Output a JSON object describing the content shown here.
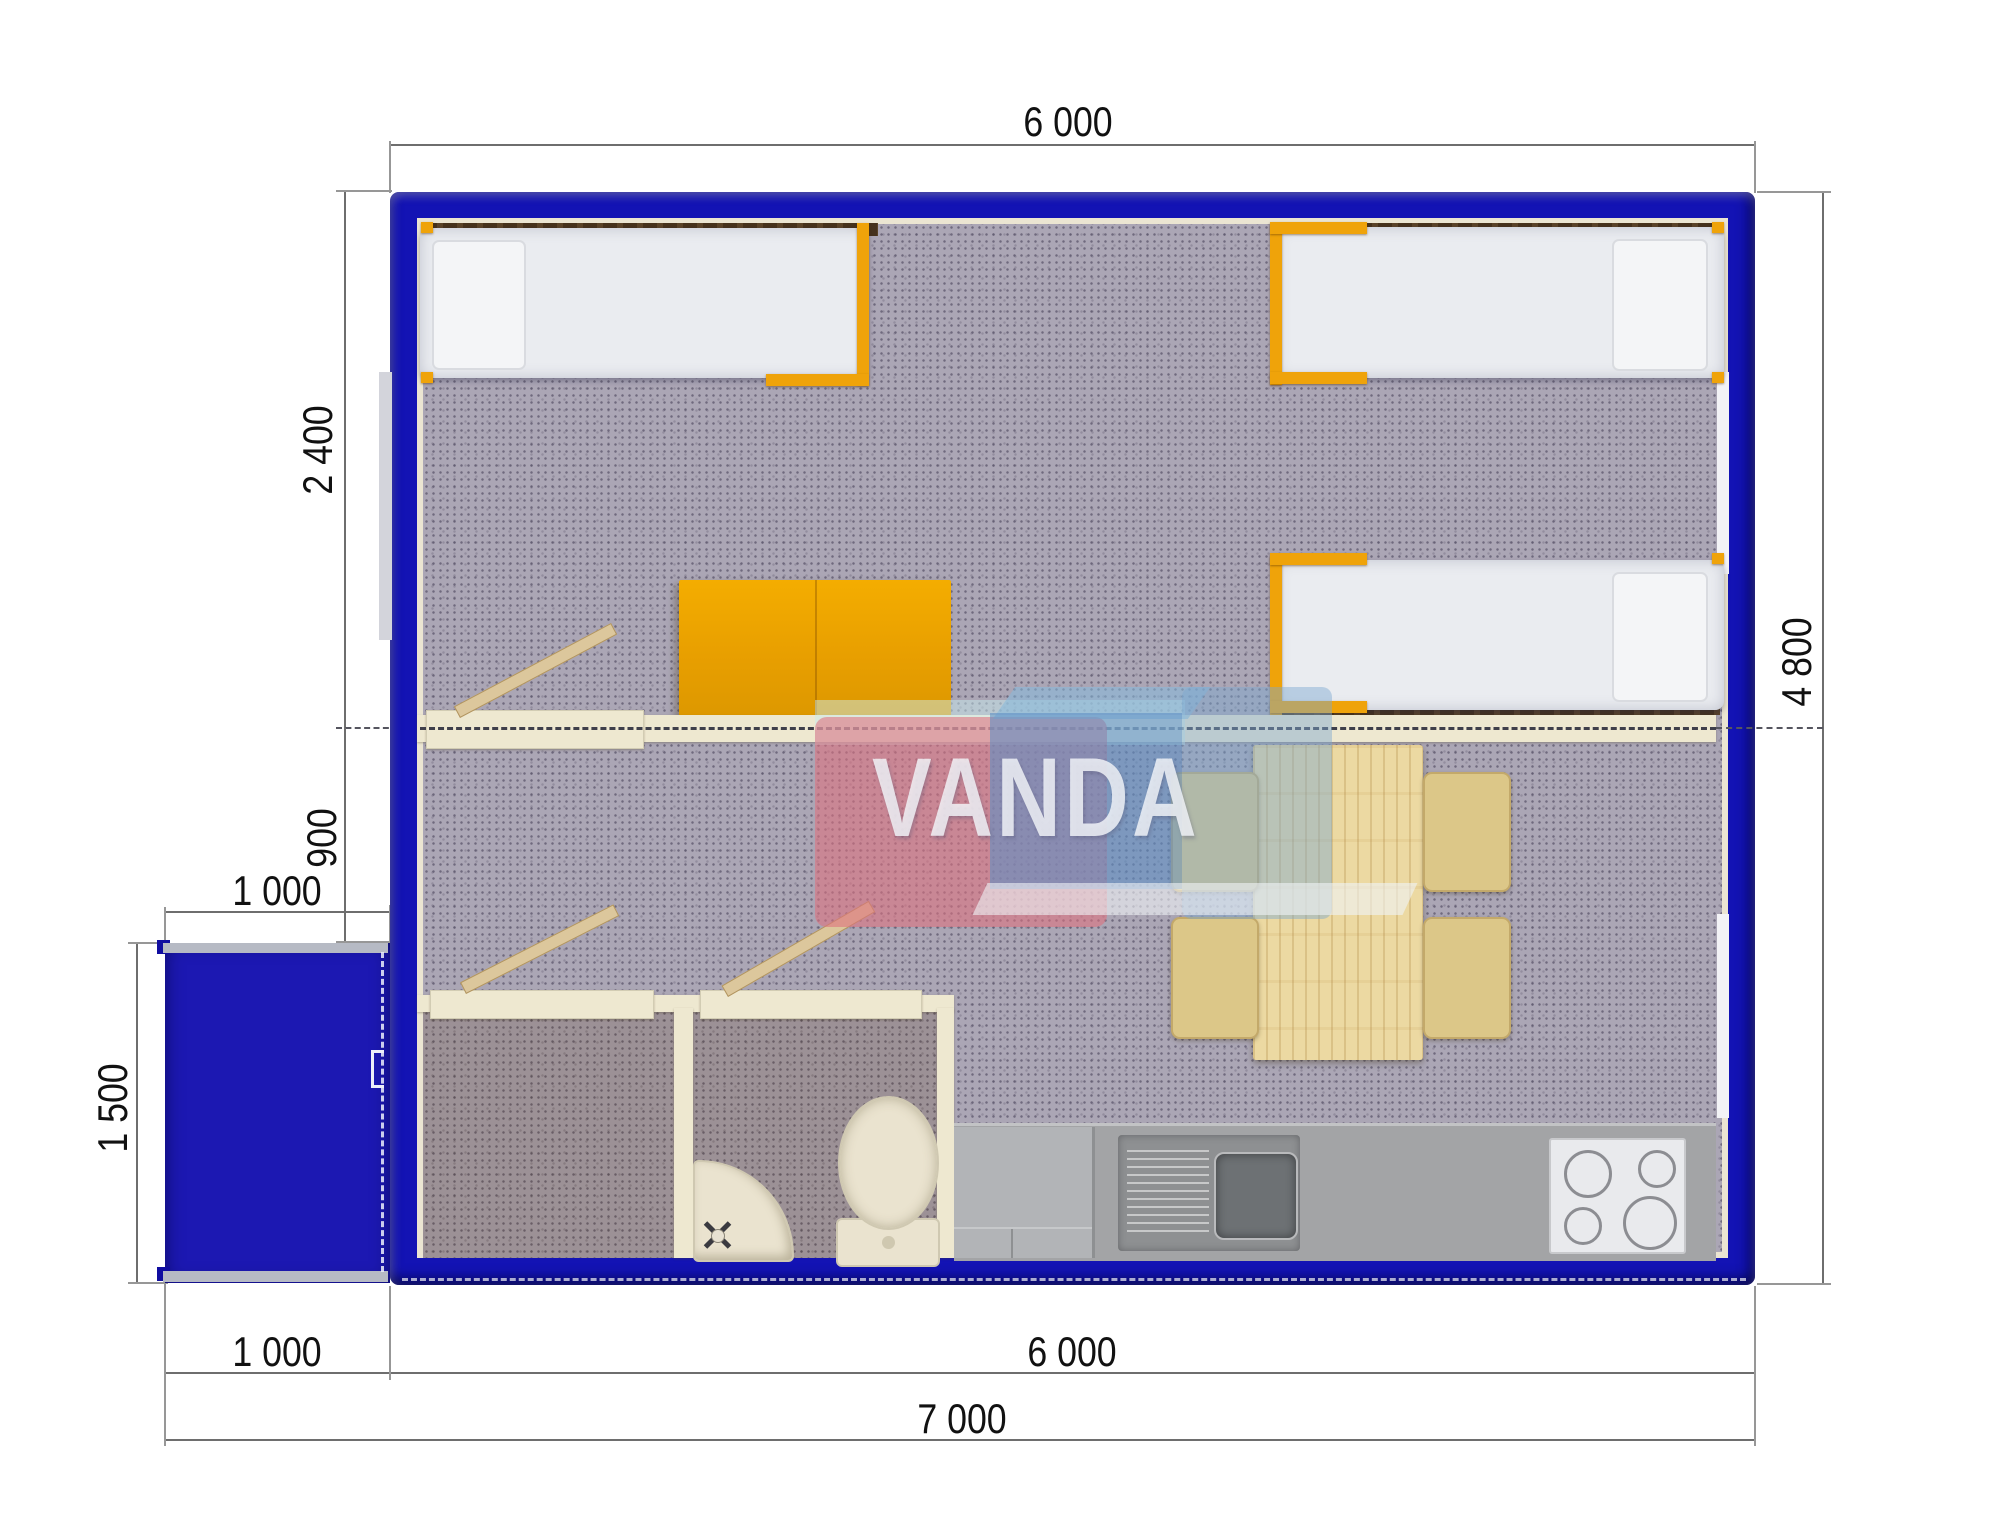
{
  "drawing": {
    "kind": "modular cabin floor plan (top-down 3D render)",
    "watermark": {
      "text": "VANDA"
    }
  },
  "dimensions": {
    "top_width": "6 000",
    "bedroom_depth": "2 400",
    "entry_opening": "900",
    "annex_width": "1 000",
    "annex_depth": "1 500",
    "side_depth": "4 800",
    "bottom_annex_width": "1 000",
    "bottom_main_width": "6 000",
    "bottom_total_width": "7 000"
  },
  "colors": {
    "wall_blue": "#1313b4",
    "accent_orange": "#efa30a",
    "partition_cream": "#eee8d0",
    "carpet_gray": "#aba6b5",
    "bathroom_floor": "#9c9196",
    "kitchen_gray": "#a3a4a6",
    "wood_light": "#ecd9a2",
    "chair_tan": "#dcc788",
    "window_band_brown": "#46321d",
    "dimension_line_gray": "#6e6e6e"
  },
  "inventory": [
    "single-bed",
    "single-bed",
    "single-bed",
    "orange-desk-table",
    "dining-table",
    "chair",
    "chair",
    "chair",
    "chair",
    "toilet",
    "corner-washbasin",
    "kitchen-sink",
    "stove-hob",
    "kitchen-counter",
    "entrance-porch",
    "interior-door",
    "interior-door",
    "interior-door"
  ]
}
